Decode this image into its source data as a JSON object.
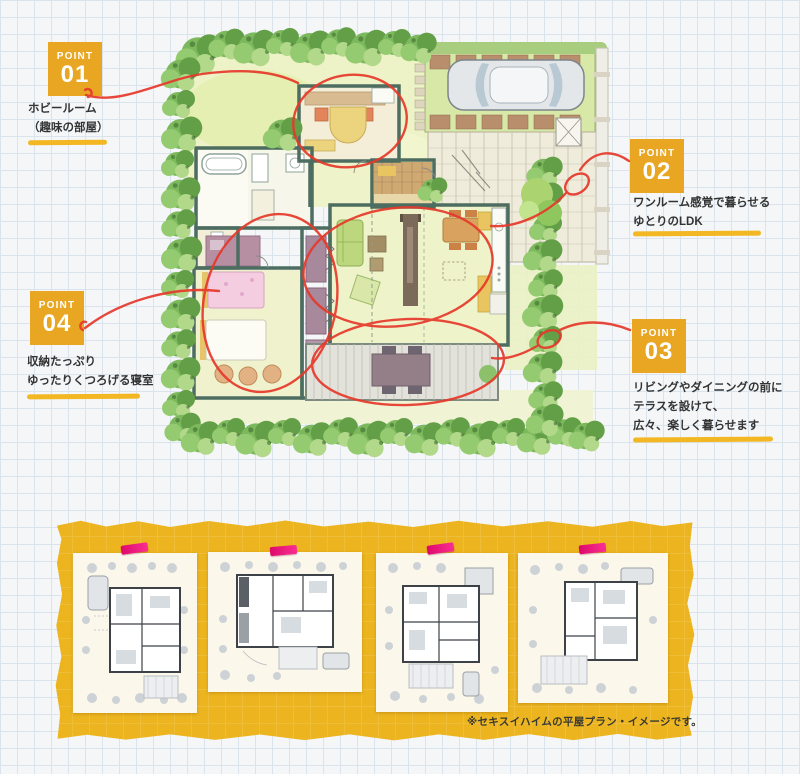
{
  "points": [
    {
      "tag": "POINT",
      "number": "01",
      "lines": [
        "ホビールーム",
        "（趣味の部屋）"
      ]
    },
    {
      "tag": "POINT",
      "number": "02",
      "lines": [
        "ワンルーム感覚で暮らせる",
        "ゆとりのLDK"
      ]
    },
    {
      "tag": "POINT",
      "number": "03",
      "lines": [
        "リビングやダイニングの前に",
        "テラスを設けて、",
        "広々、楽しく暮らせます"
      ]
    },
    {
      "tag": "POINT",
      "number": "04",
      "lines": [
        "収納たっぷり",
        "ゆったりくつろげる寝室"
      ]
    }
  ],
  "footer": {
    "caption": "※セキスイハイムの平屋プラン・イメージです。",
    "thumbnail_count": "4"
  },
  "colors": {
    "badge_orange": "#e9a622",
    "underline_yellow": "#f2b722",
    "annotation_red": "#e6392b",
    "band_yellow": "#ecb41e",
    "tape_pink": "#f0117c",
    "text_dark": "#333333"
  }
}
